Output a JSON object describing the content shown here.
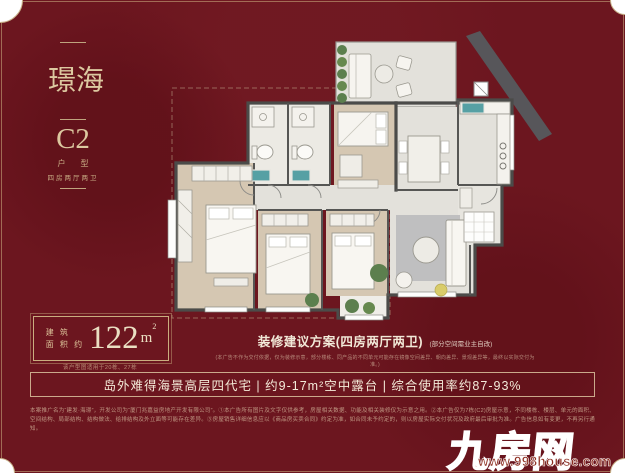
{
  "theme": {
    "background_red": "#6C161F",
    "gold_text": "#DCC8A0",
    "cream_text": "#F4EBD9",
    "wall_color": "#4B4B49",
    "wood_floor": "#D5C7B2",
    "tile_floor": "#E3E1DB",
    "sink_teal": "#56A0A4",
    "plant_green": "#5C7F4E",
    "logo_red": "#C53028"
  },
  "left_panel": {
    "project_name": "海璟",
    "unit_code": "C2",
    "unit_type_label": "户型",
    "unit_type_desc": "四房两厅两卫"
  },
  "area": {
    "label_line1": "建 筑",
    "label_line2": "面 积 约",
    "value": "122",
    "unit": "m",
    "unit_sup": "2",
    "note": "该户型图适用于20栋、27栋"
  },
  "renovation": {
    "title": "装修建议方案(四房两厅两卫)",
    "title_note": "(部分空间需业主自改)",
    "disclaimer": "(本广告不作为交付依据，仅为装修示意，部分楼栋、同产品的不同单元可能存在镜像空间差异、朝向差异、景观差异等，最终以实际交付为准。)"
  },
  "banner": {
    "text": "岛外难得海景高层四代宅 | 约9-17m²空中露台 | 综合使用率约87-93%"
  },
  "footer": {
    "disclaimer": "本案推广名为“建发·海璟”，开发公司为“厦门兆嘉益房地产开发有限公司”。①本广告所有图片及文字仅供参考，房屋相关数据、功能及相关装修仅为示意之用。②本广告仅为7栋(C2)房屋示意，不同楼栋、楼层、单元的面积、空间结构、局部结构、结构做法、给排结构及外立面等可能存在差异。③房屋销售详细信息应以《商品房买卖合同》约定为准，如合同未予约定的，则以房屋实际交付状况及政府最后审批为准。广告信息如有变更，不再另行通知。"
  },
  "watermark": {
    "logo": "九房网",
    "url": "www.998house.com"
  }
}
